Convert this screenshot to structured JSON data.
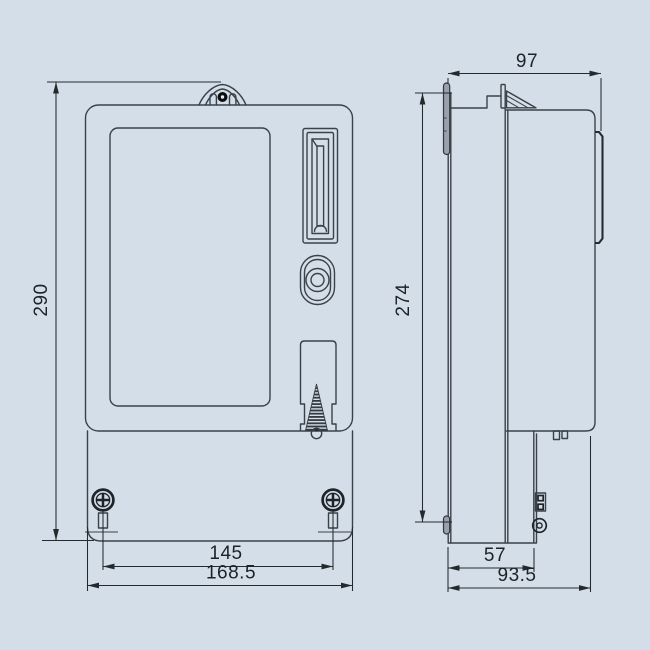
{
  "drawing": {
    "kind": "technical-outline-drawing",
    "subject": "electric energy meter, front and side views with dimensions",
    "background_color": "#d4dee9",
    "line_color": "#3a4148",
    "dimension_color": "#24292e",
    "dimensions": {
      "height_overall": "290",
      "mounting_hole_spacing": "145",
      "width_overall": "168.5",
      "depth_overall": "97",
      "body_height": "274",
      "terminal_cover_depth": "57",
      "base_depth": "93.5"
    }
  }
}
